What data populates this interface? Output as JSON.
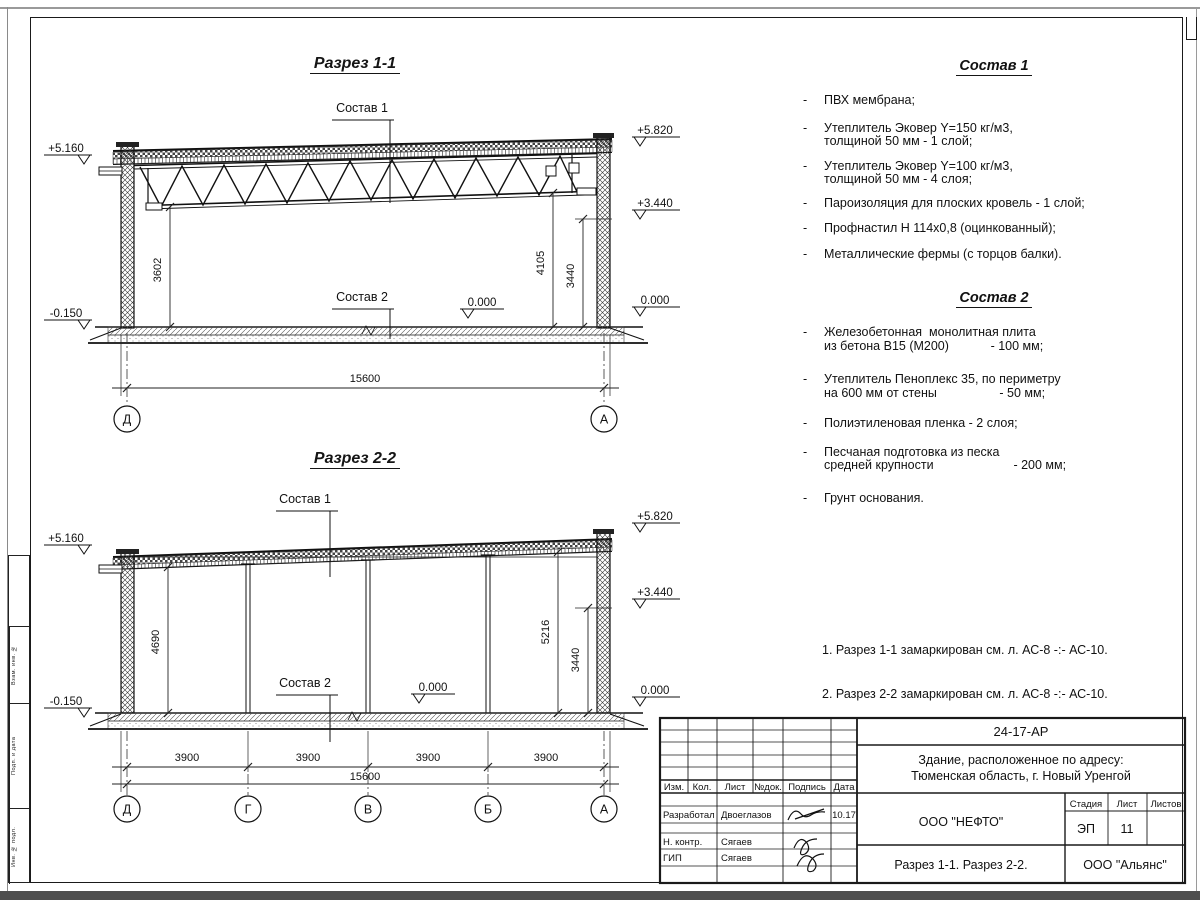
{
  "frame": {
    "stamp_labels": [
      "Взам. инв. №",
      "Подп. и дата",
      "Инв. № подл."
    ]
  },
  "section1": {
    "title": "Разрез 1-1",
    "sostav1_label": "Состав 1",
    "sostav2_label": "Состав 2",
    "elev": {
      "left_top": "+5.160",
      "left_bottom": "-0.150",
      "right_top": "+5.820",
      "right_mid": "+3.440",
      "right_zero": "0.000",
      "floor_zero": "0.000"
    },
    "dims": {
      "left": "3602",
      "right_a": "4105",
      "right_b": "3440",
      "total": "15600"
    },
    "axes": {
      "left": "Д",
      "right": "А"
    }
  },
  "section2": {
    "title": "Разрез 2-2",
    "sostav1_label": "Состав 1",
    "sostav2_label": "Состав 2",
    "elev": {
      "left_top": "+5.160",
      "left_bottom": "-0.150",
      "right_top": "+5.820",
      "right_mid": "+3.440",
      "right_zero": "0.000",
      "floor_zero": "0.000"
    },
    "dims": {
      "left": "4690",
      "right_a": "5216",
      "right_b": "3440",
      "bays": [
        "3900",
        "3900",
        "3900",
        "3900"
      ],
      "total": "15600"
    },
    "axes": [
      "Д",
      "Г",
      "В",
      "Б",
      "А"
    ]
  },
  "sostav1": {
    "title": "Состав 1",
    "dash": "-",
    "items": [
      "ПВХ мембрана;",
      "Утеплитель Эковер Y=150 кг/м3,\nтолщиной 50 мм - 1 слой;",
      "Утеплитель Эковер Y=100 кг/м3,\nтолщиной 50 мм - 4 слоя;",
      "Пароизоляция для плоских кровель - 1 слой;",
      "Профнастил Н 114х0,8 (оцинкованный);",
      "Металлические фермы (с торцов балки)."
    ]
  },
  "sostav2": {
    "title": "Состав 2",
    "dash": "-",
    "items": [
      "Железобетонная  монолитная плита\nиз бетона В15 (М200)            - 100 мм;",
      "Утеплитель Пеноплекс 35, по периметру\nна 600 мм от стены                  - 50 мм;",
      "Полиэтиленовая пленка - 2 слоя;",
      "Песчаная подготовка из песка\nсредней крупности                       - 200 мм;",
      "Грунт основания."
    ]
  },
  "notes": [
    "1. Разрез 1-1 замаркирован см. л. АС-8 -:- АС-10.",
    "2. Разрез 2-2 замаркирован см. л. АС-8 -:- АС-10."
  ],
  "titleblock": {
    "doc_code": "24-17-АР",
    "project_line1": "Здание, расположенное по адресу:",
    "project_line2": "Тюменская область, г. Новый Уренгой",
    "header_cols": [
      "Изм.",
      "Кол.",
      "Лист",
      "№док.",
      "Подпись",
      "Дата"
    ],
    "rows": [
      {
        "role": "Разработал",
        "name": "Двоеглазов",
        "date": "10.17"
      },
      {
        "role": "Н. контр.",
        "name": "Сягаев",
        "date": ""
      },
      {
        "role": "ГИП",
        "name": "Сягаев",
        "date": ""
      }
    ],
    "company": "ООО \"НЕФТО\"",
    "stage_label": "Стадия",
    "sheet_label": "Лист",
    "sheets_label": "Листов",
    "stage": "ЭП",
    "sheet_no": "11",
    "sheets_total": "",
    "subject": "Разрез 1-1. Разрез 2-2.",
    "contractor": "ООО \"Альянс\""
  }
}
